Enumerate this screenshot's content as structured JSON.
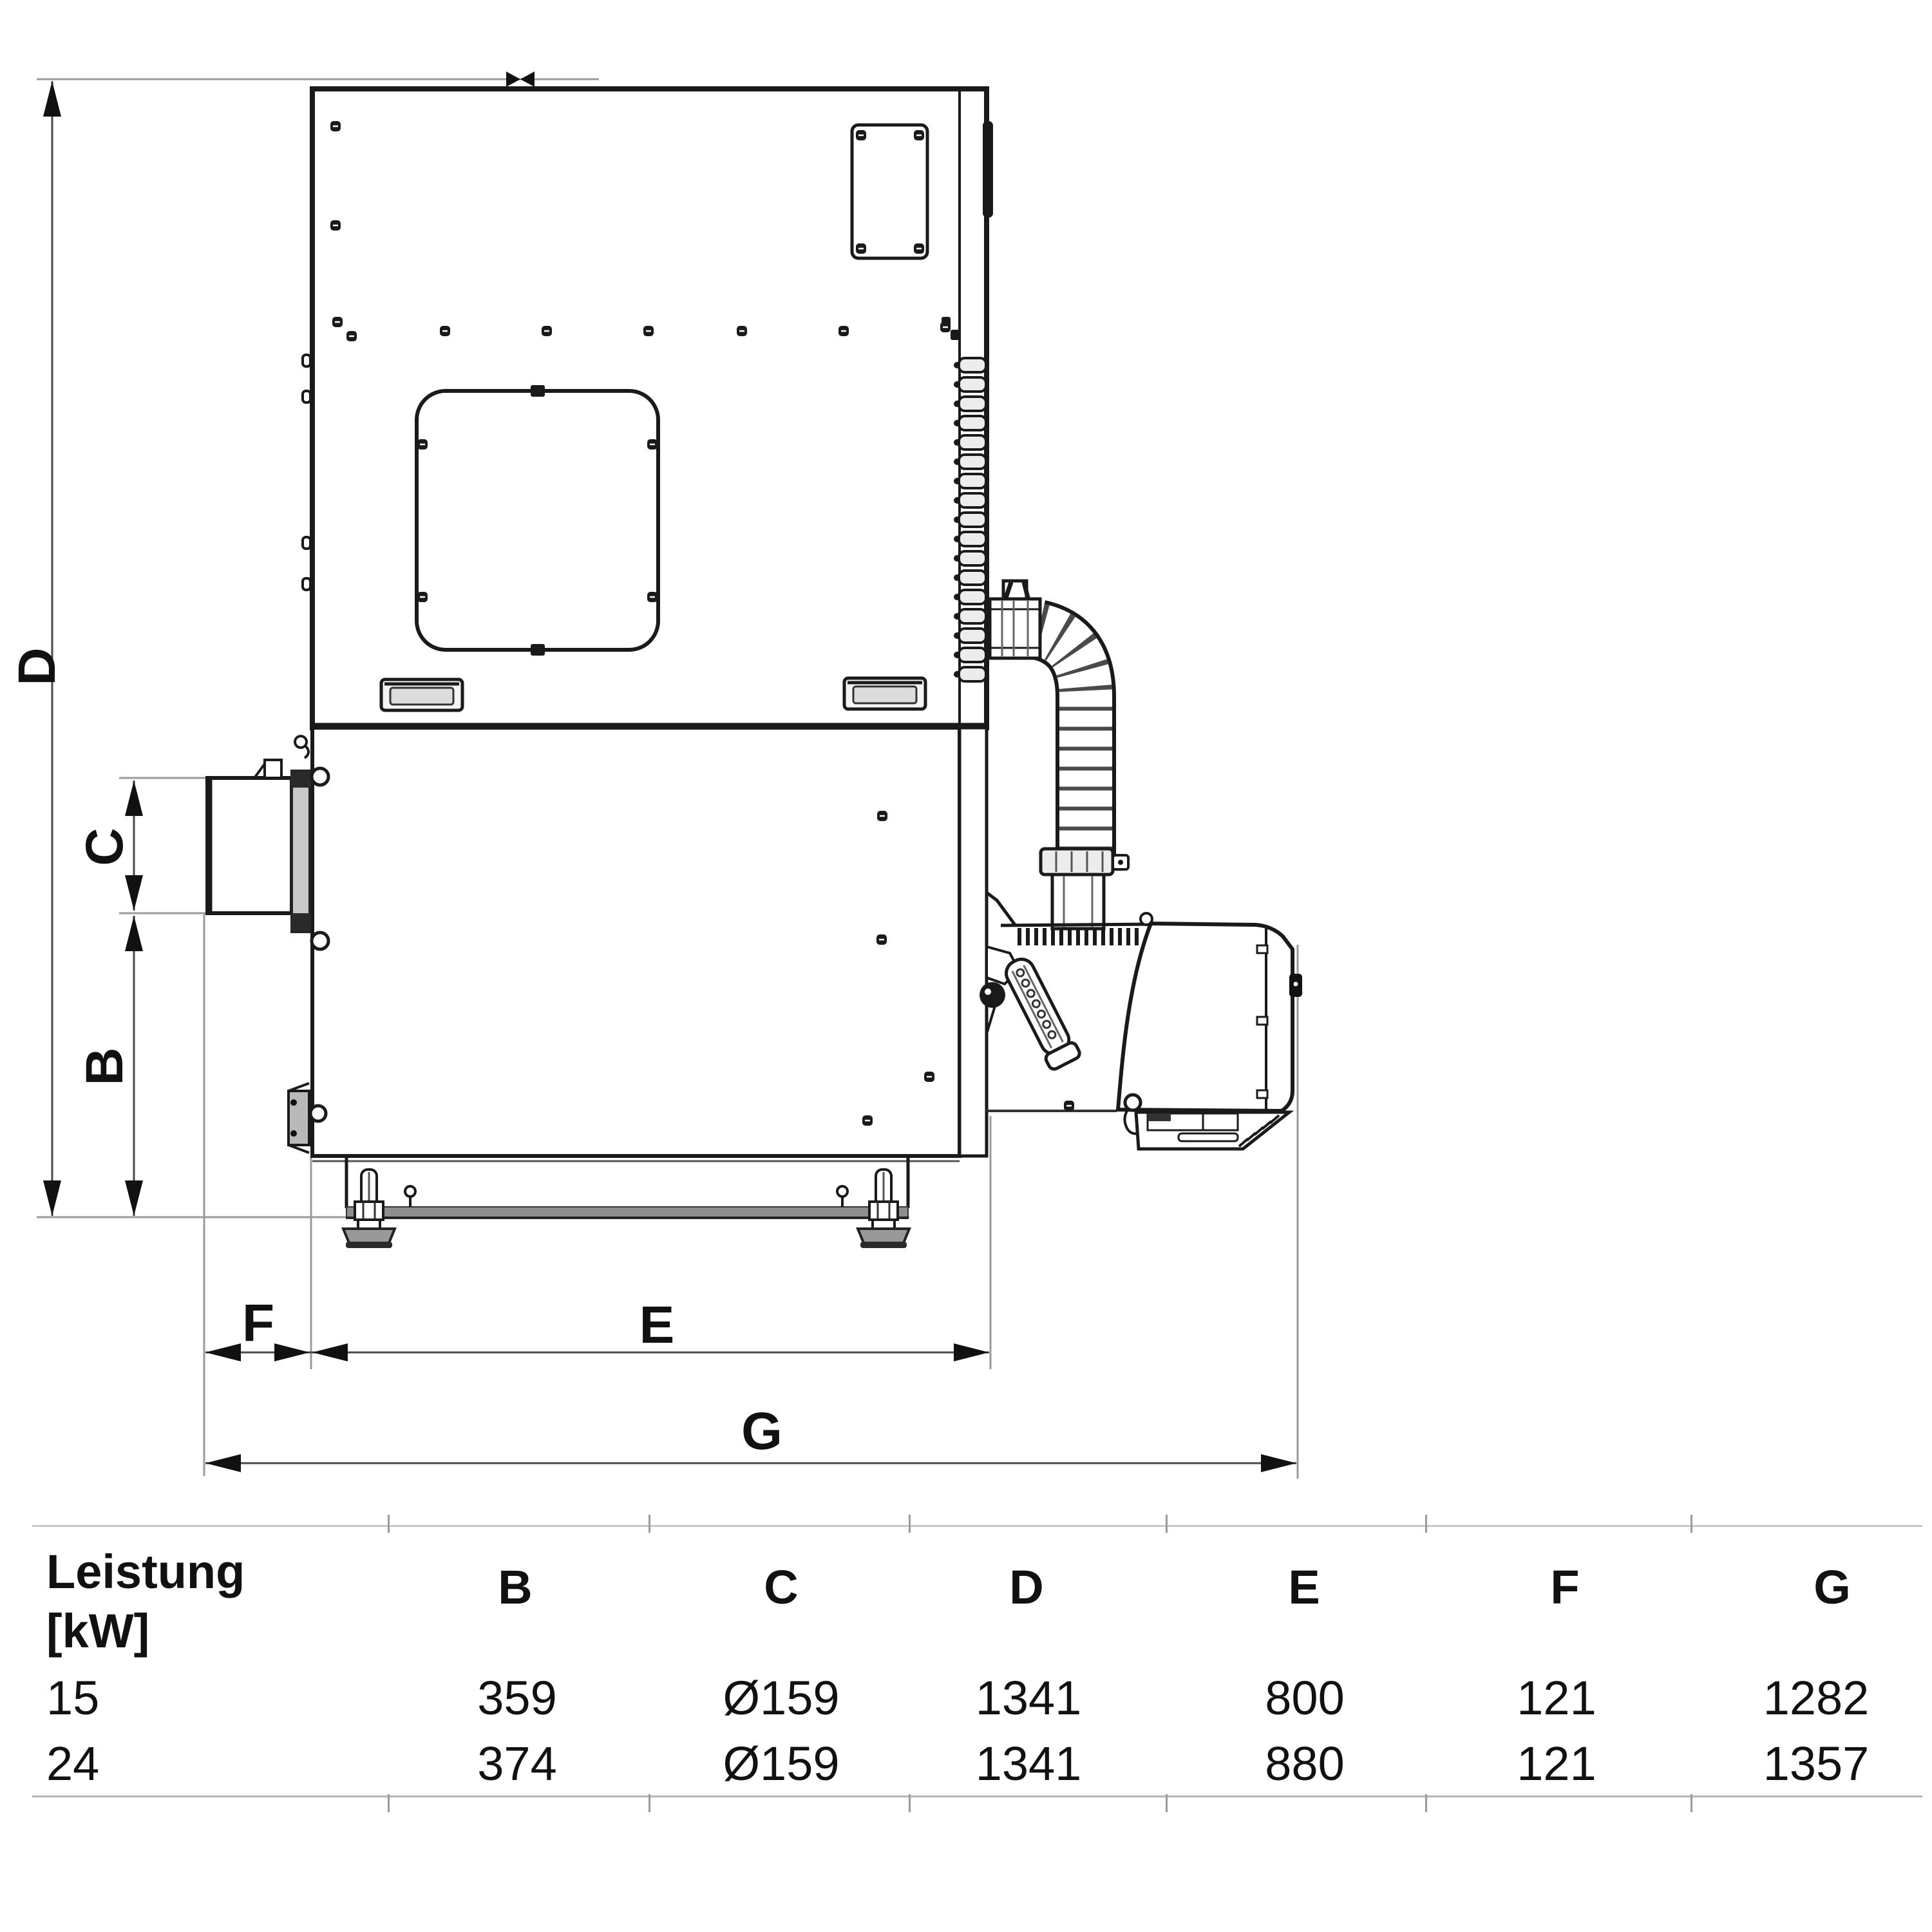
{
  "drawing": {
    "type": "technical-dimension-drawing",
    "subject": "pellet boiler side view",
    "labels": {
      "B": "B",
      "C": "C",
      "D": "D",
      "E": "E",
      "F": "F",
      "G": "G"
    },
    "colors": {
      "line": "#1a1a1a",
      "dimension_line": "#4a4a4a",
      "extension_line": "#9a9a9a",
      "metal_fill": "#8e8e8e",
      "background": "#ffffff"
    }
  },
  "table": {
    "row_header_title": "Leistung",
    "row_header_unit": "[kW]",
    "columns": [
      "B",
      "C",
      "D",
      "E",
      "F",
      "G"
    ],
    "rows": [
      {
        "power": "15",
        "values": [
          "359",
          "Ø159",
          "1341",
          "800",
          "121",
          "1282"
        ]
      },
      {
        "power": "24",
        "values": [
          "374",
          "Ø159",
          "1341",
          "880",
          "121",
          "1357"
        ]
      }
    ]
  }
}
